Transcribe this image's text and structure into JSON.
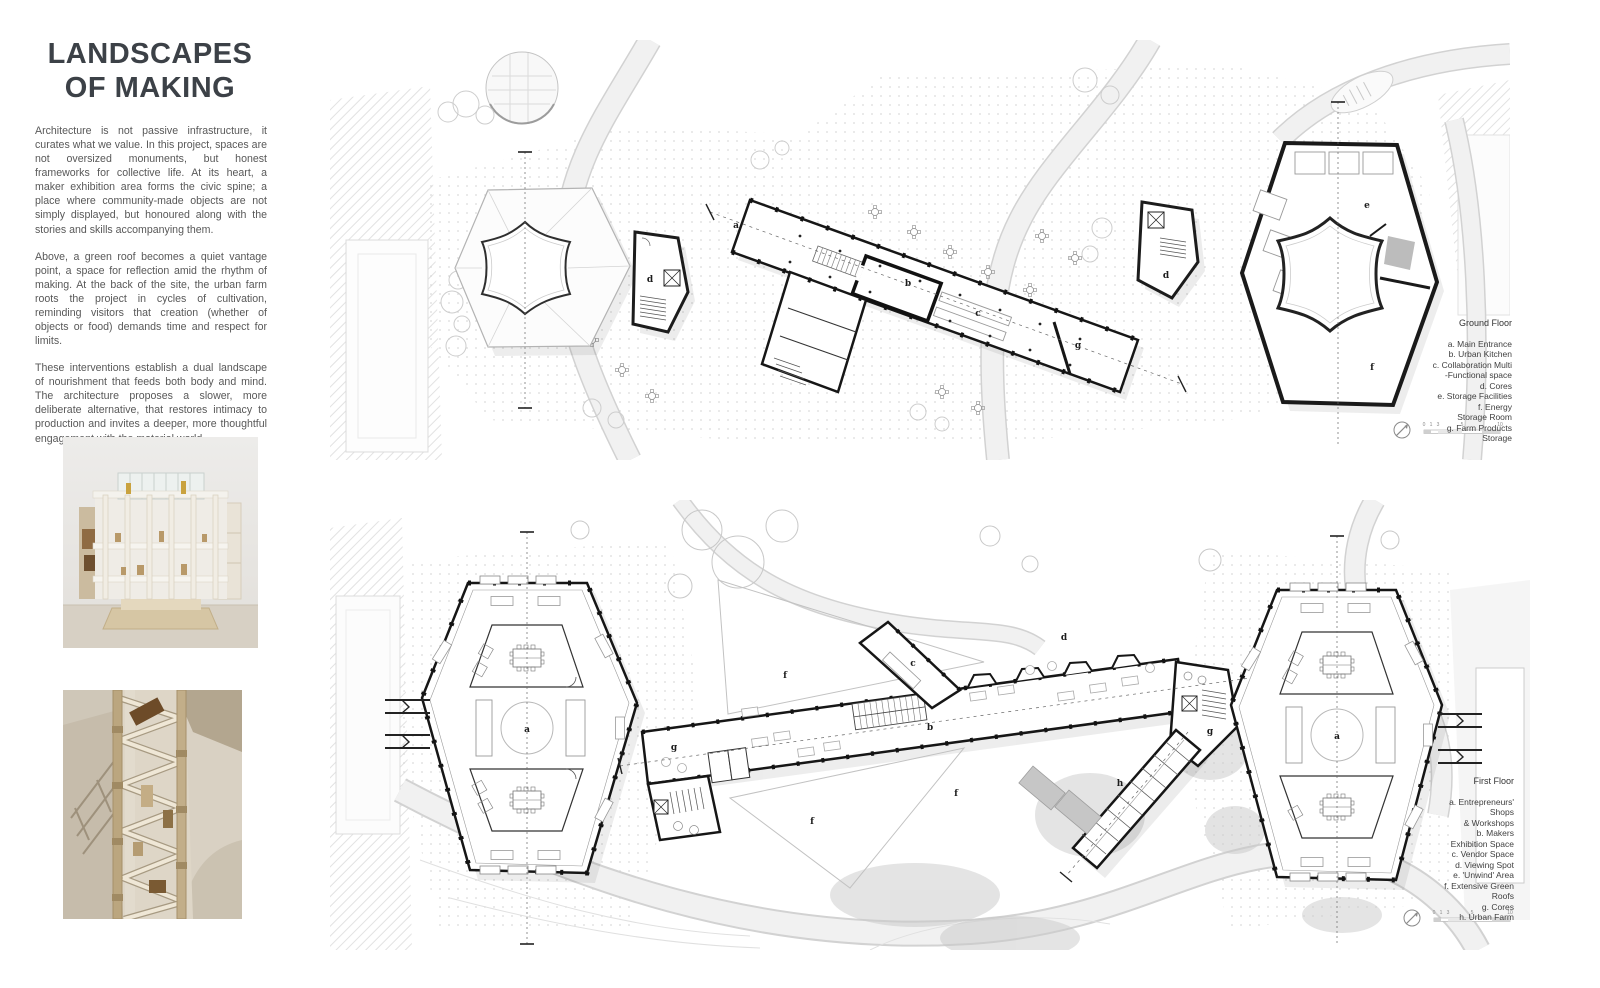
{
  "title": {
    "line1": "LANDSCAPES",
    "line2": "OF MAKING"
  },
  "intro": {
    "p1": "Architecture is not passive infrastructure, it curates what we value. In this project, spaces are not oversized monuments, but honest frameworks for collective life. At its heart, a maker exhibition area forms the civic spine; a place where community-made objects are not simply displayed, but honoured along with the stories and skills accompanying them.",
    "p2": "Above, a green roof becomes a quiet vantage point, a space for reflection amid the rhythm of making. At the back of the site, the urban farm roots the project in cycles of cultivation, reminding visitors that creation (whether of objects or food) demands time and respect for limits.",
    "p3": "These interventions establish a dual landscape of nourishment that feeds both body and mind. The architecture proposes a slower, more deliberate alternative, that restores intimacy to production and invites a deeper, more thoughtful engagement with the material world."
  },
  "ground_floor": {
    "legend_title": "Ground Floor",
    "legend_lines": [
      "a. Main Entrance",
      "b. Urban Kitchen",
      "c. Collaboration Multi",
      "-Functional space",
      "d. Cores",
      "e. Storage Facilities",
      "f. Energy",
      "Storage Room",
      "g. Farm Products",
      "Storage"
    ],
    "labels": {
      "a": "a",
      "b": "b",
      "c": "c",
      "d": "d",
      "e": "e",
      "f": "f",
      "g": "g"
    },
    "scale": {
      "t0": "0",
      "t1": "1",
      "t2": "3",
      "t3": "5",
      "t4": "10"
    }
  },
  "first_floor": {
    "legend_title": "First Floor",
    "legend_lines": [
      "a. Entrepreneurs'",
      "Shops",
      "& Workshops",
      "b. Makers",
      "Exhibition Space",
      "c. Vendor Space",
      "d. Viewing Spot",
      "e. 'Unwind' Area",
      "f. Extensive Green",
      "Roofs",
      "g. Cores",
      "h. Urban Farm"
    ],
    "labels": {
      "a": "a",
      "b": "b",
      "c": "c",
      "d": "d",
      "f": "f",
      "g": "g",
      "h": "h"
    },
    "scale": {
      "t0": "0",
      "t1": "1",
      "t2": "3",
      "t3": "5",
      "t4": "10"
    }
  }
}
